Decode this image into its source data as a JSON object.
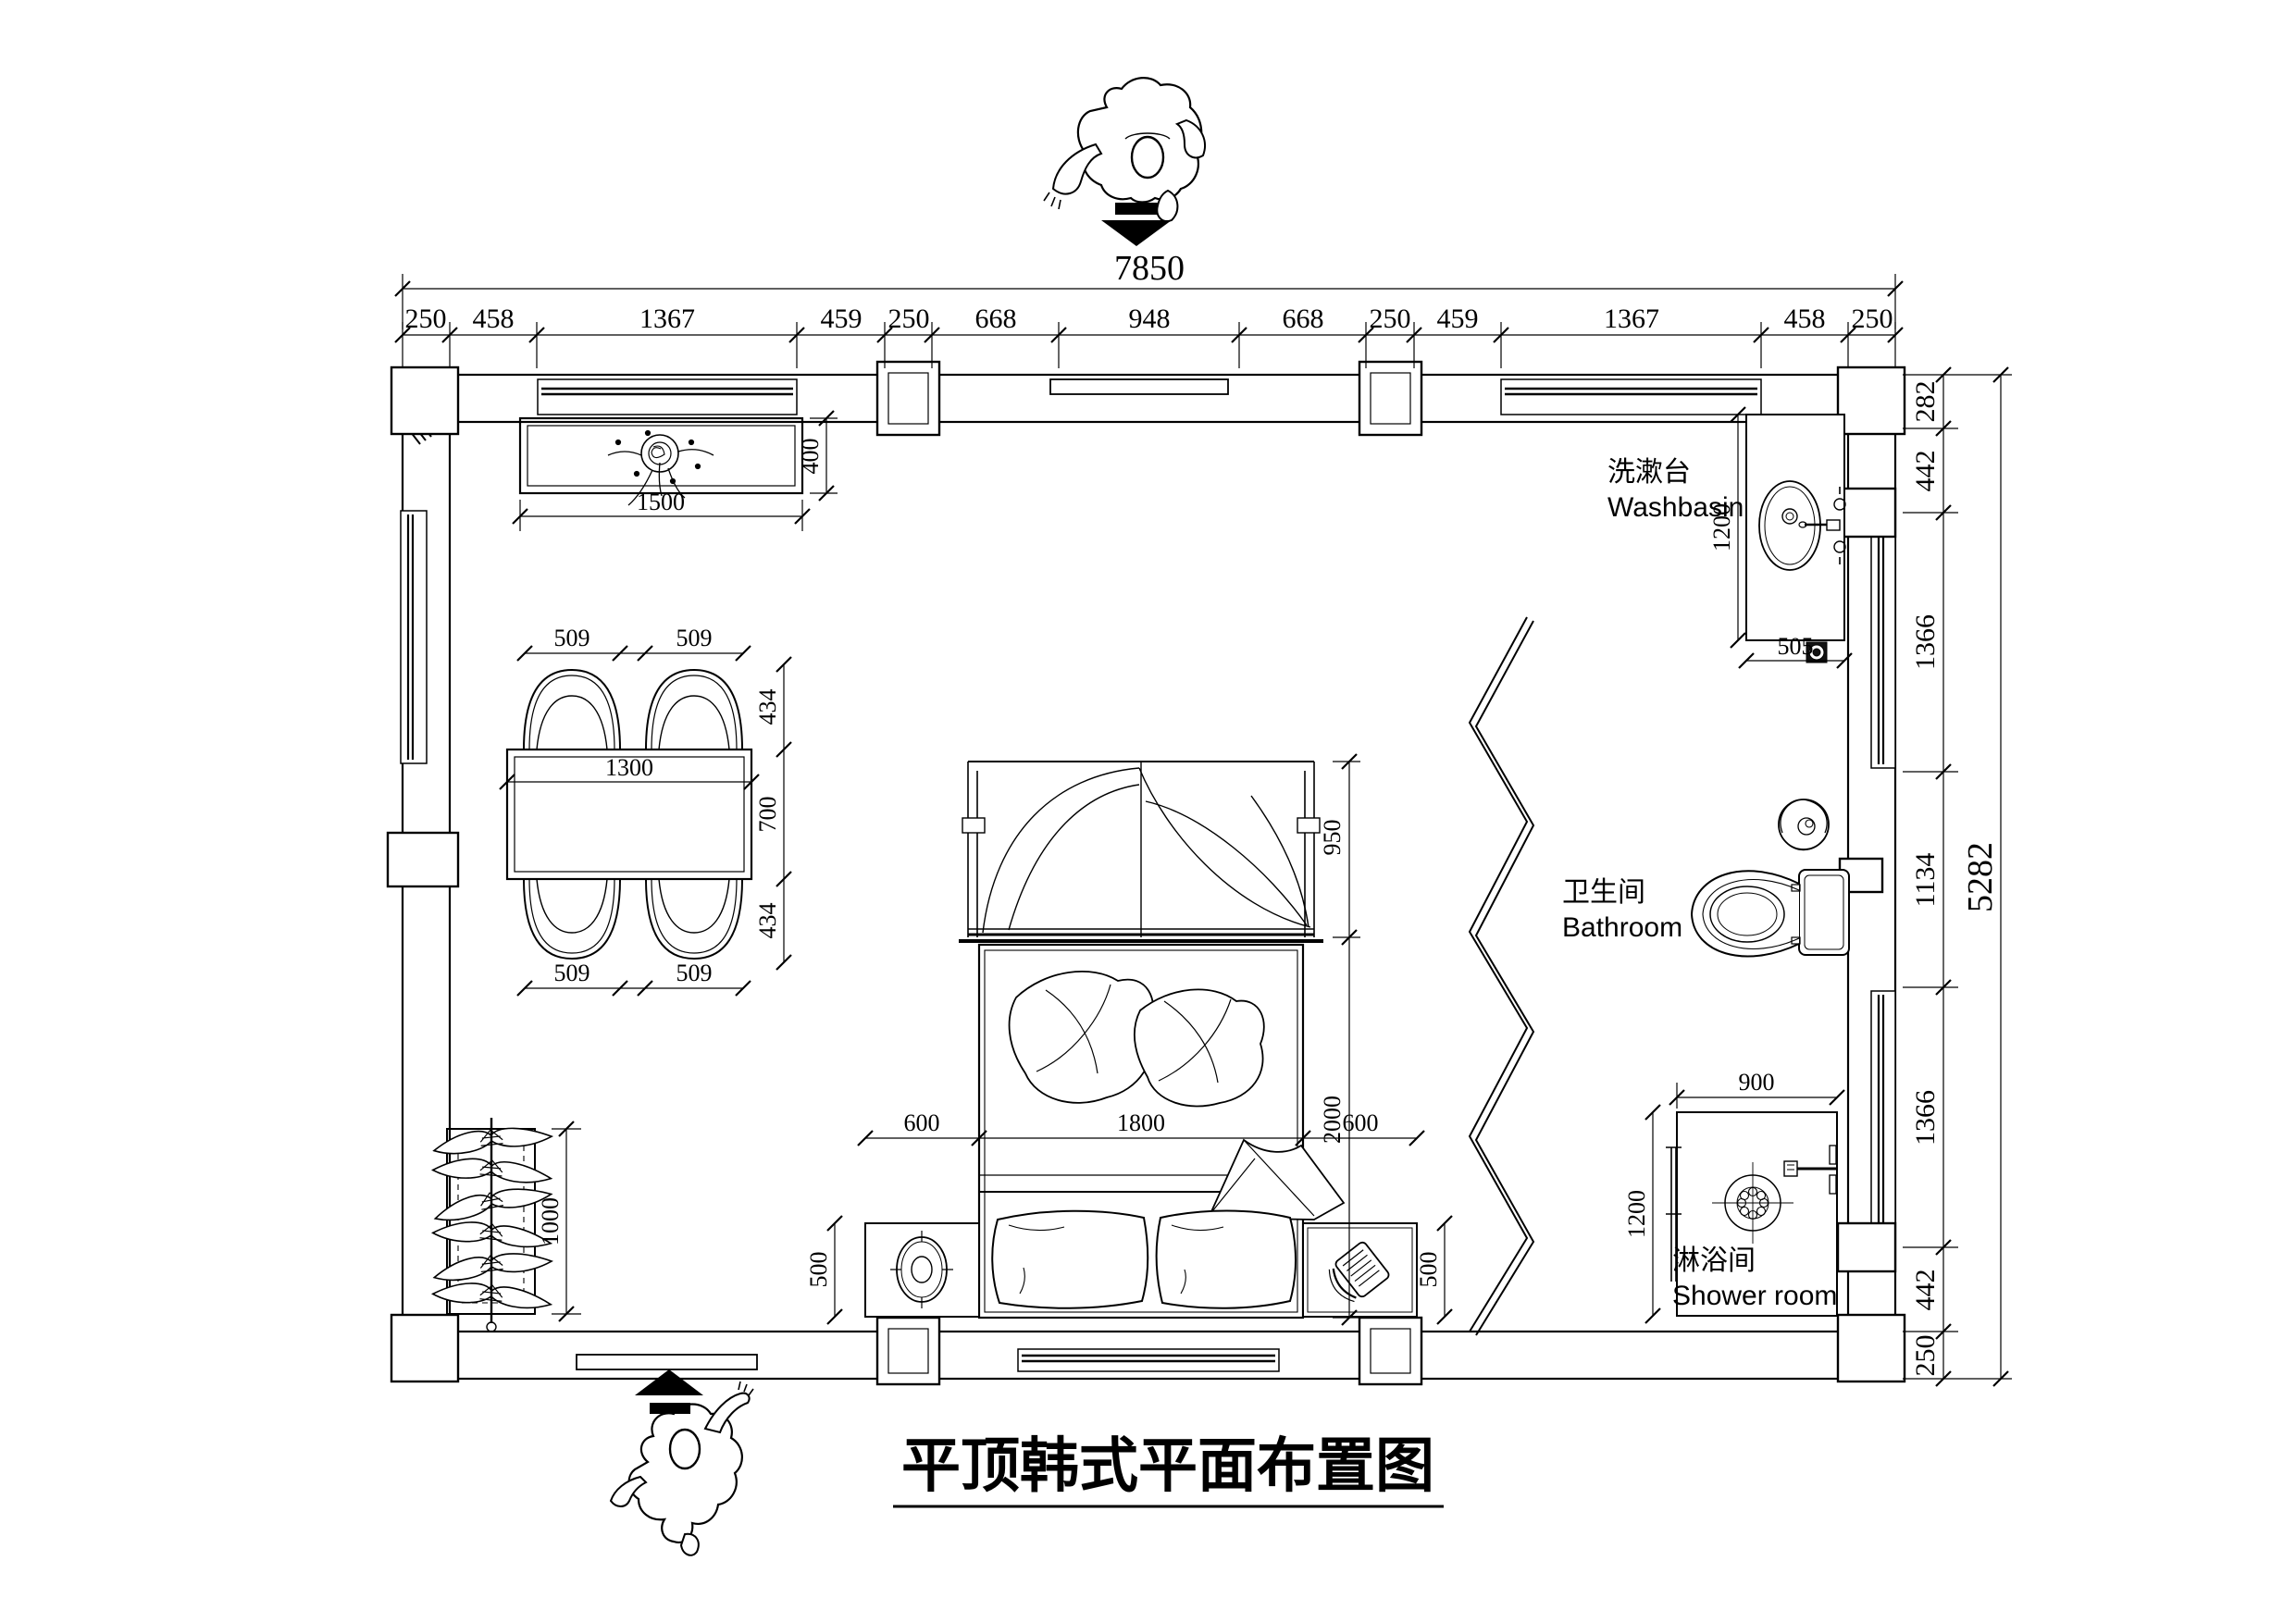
{
  "title": "平顶韩式平面布置图",
  "rooms": {
    "washbasin": {
      "zh": "洗漱台",
      "en": "Washbasin"
    },
    "bathroom": {
      "zh": "卫生间",
      "en": "Bathroom"
    },
    "shower": {
      "zh": "淋浴间",
      "en": "Shower room"
    }
  },
  "dims": {
    "top_total": "7850",
    "top_chain": [
      "250",
      "458",
      "1367",
      "459",
      "250",
      "668",
      "948",
      "668",
      "250",
      "459",
      "1367",
      "458",
      "250"
    ],
    "right_total": "5282",
    "right_chain": [
      "282",
      "442",
      "1366",
      "1134",
      "1366",
      "442",
      "250"
    ],
    "tv_cabinet": {
      "width": "1500",
      "depth": "400"
    },
    "dining": {
      "chair_tl": "509",
      "chair_tr": "509",
      "chair_bl": "509",
      "chair_br": "509",
      "chair_depth_top": "434",
      "table_depth": "700",
      "chair_depth_bottom": "434",
      "table_width": "1300"
    },
    "bed": {
      "headboard": "950",
      "length": "2000",
      "left_nightstand_w": "600",
      "width": "1800",
      "right_nightstand_w": "600",
      "nightstand_left_d": "500",
      "nightstand_right_d": "500"
    },
    "wardrobe": {
      "length": "1000"
    },
    "washbasin": {
      "counter_length": "1200",
      "counter_width": "505"
    },
    "shower": {
      "width": "900",
      "depth": "1200"
    }
  }
}
